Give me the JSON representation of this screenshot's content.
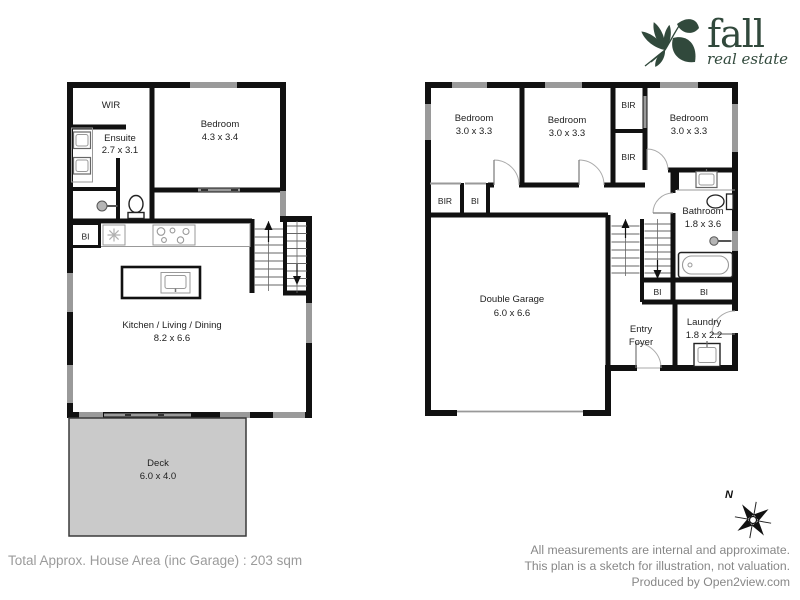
{
  "logo": {
    "brand": "fall",
    "tagline": "real estate"
  },
  "left_plan": {
    "wir": {
      "name": "WIR"
    },
    "ensuite": {
      "name": "Ensuite",
      "dims": "2.7 x 3.1"
    },
    "bedroom": {
      "name": "Bedroom",
      "dims": "4.3 x 3.4"
    },
    "kitchen_cupboard": "BI",
    "kitchen": {
      "name": "Kitchen / Living / Dining",
      "dims": "8.2 x 6.6"
    },
    "deck": {
      "name": "Deck",
      "dims": "6.0 x 4.0"
    }
  },
  "right_plan": {
    "bedroom1": {
      "name": "Bedroom",
      "dims": "3.0 x 3.3"
    },
    "bedroom2": {
      "name": "Bedroom",
      "dims": "3.0 x 3.3"
    },
    "bedroom3": {
      "name": "Bedroom",
      "dims": "3.0 x 3.3"
    },
    "robe_top": "BIR",
    "robe_mid": "BIR",
    "hall_robe": "BIR",
    "hall_cupboard": "BI",
    "bathroom": {
      "name": "Bathroom",
      "dims": "1.8 x 3.6"
    },
    "garage": {
      "name": "Double Garage",
      "dims": "6.0 x 6.6"
    },
    "entry": {
      "line1": "Entry",
      "line2": "Foyer"
    },
    "laundry": {
      "name": "Laundry",
      "dims": "1.8 x 2.2"
    },
    "cupboard_left": "BI",
    "cupboard_right": "BI"
  },
  "compass": {
    "north": "N"
  },
  "footer": {
    "total_area": "Total Approx. House Area (inc Garage) : 203 sqm",
    "disclaimer1": "All measurements are internal and approximate.",
    "disclaimer2": "This plan is a sketch for illustration, not valuation.",
    "disclaimer3": "Produced by Open2view.com"
  },
  "colors": {
    "wall": "#111111",
    "window": "#9a9a9a",
    "deck_fill": "#cacaca",
    "logo_green": "#31493c",
    "muted_text": "#8f8f8f"
  }
}
